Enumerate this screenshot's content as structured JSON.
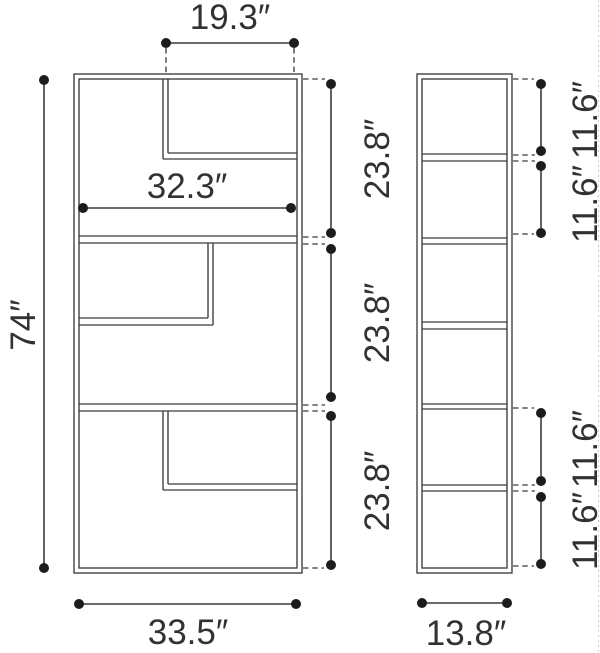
{
  "drawing": {
    "front_view": {
      "overall_height": "74″",
      "overall_width": "33.5″",
      "top_opening_width": "19.3″",
      "inner_shelf_width": "32.3″",
      "section_heights": [
        "23.8″",
        "23.8″",
        "23.8″"
      ]
    },
    "side_view": {
      "depth": "13.8″",
      "compartment_heights": [
        "11.6″",
        "11.6″",
        "11.6″",
        "11.6″"
      ]
    }
  },
  "colors": {
    "bg": "#ffffff",
    "line": "#3a3a3c",
    "text": "#323234",
    "dot": "#1c1c1e",
    "edge": "#cccccc"
  }
}
